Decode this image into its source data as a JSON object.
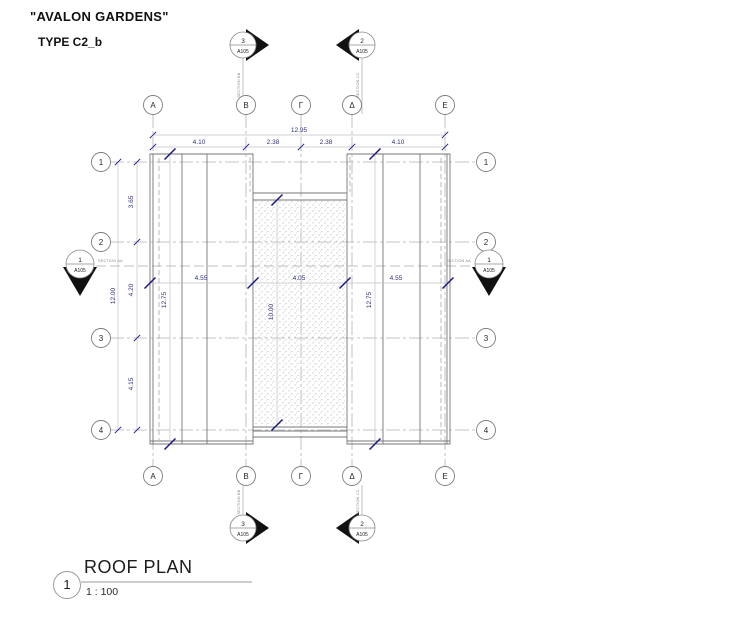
{
  "header": {
    "project_title": "\"AVALON GARDENS\"",
    "type_label": "TYPE C2_b"
  },
  "grid": {
    "columns": [
      "A",
      "B",
      "Γ",
      "Δ",
      "E"
    ],
    "rows": [
      "1",
      "2",
      "3",
      "4"
    ]
  },
  "dimensions": {
    "top_total": "12.95",
    "top_segments": [
      "4.10",
      "2.38",
      "2.38",
      "4.10"
    ],
    "left_total": "12.00",
    "left_segments": [
      "3.65",
      "4.20",
      "4.15"
    ],
    "middle_segments": [
      "4.55",
      "4.05",
      "4.55"
    ],
    "vertical_panels": [
      "12.75",
      "10.00",
      "12.75"
    ]
  },
  "section_markers": {
    "top_left": {
      "number": "3",
      "sheet": "A105"
    },
    "top_right": {
      "number": "2",
      "sheet": "A105"
    },
    "bottom_left": {
      "number": "3",
      "sheet": "A105"
    },
    "bottom_right": {
      "number": "2",
      "sheet": "A105"
    },
    "side_left": {
      "number": "1",
      "sheet": "A105"
    },
    "side_right": {
      "number": "1",
      "sheet": "A105"
    },
    "section_aa_label": "SECTION AA",
    "section_bb_label": "SECTION BB",
    "section_cc_label": "SECTION CC"
  },
  "title_block": {
    "number": "1",
    "title": "ROOF PLAN",
    "scale": "1 : 100"
  },
  "colors": {
    "dimension_text": "#31317e",
    "tick_mark": "#22229e",
    "grid_line": "#b3b3b3",
    "plan_line": "#777777",
    "dim_line": "#c4c4c4",
    "marker_fill": "#111111"
  }
}
